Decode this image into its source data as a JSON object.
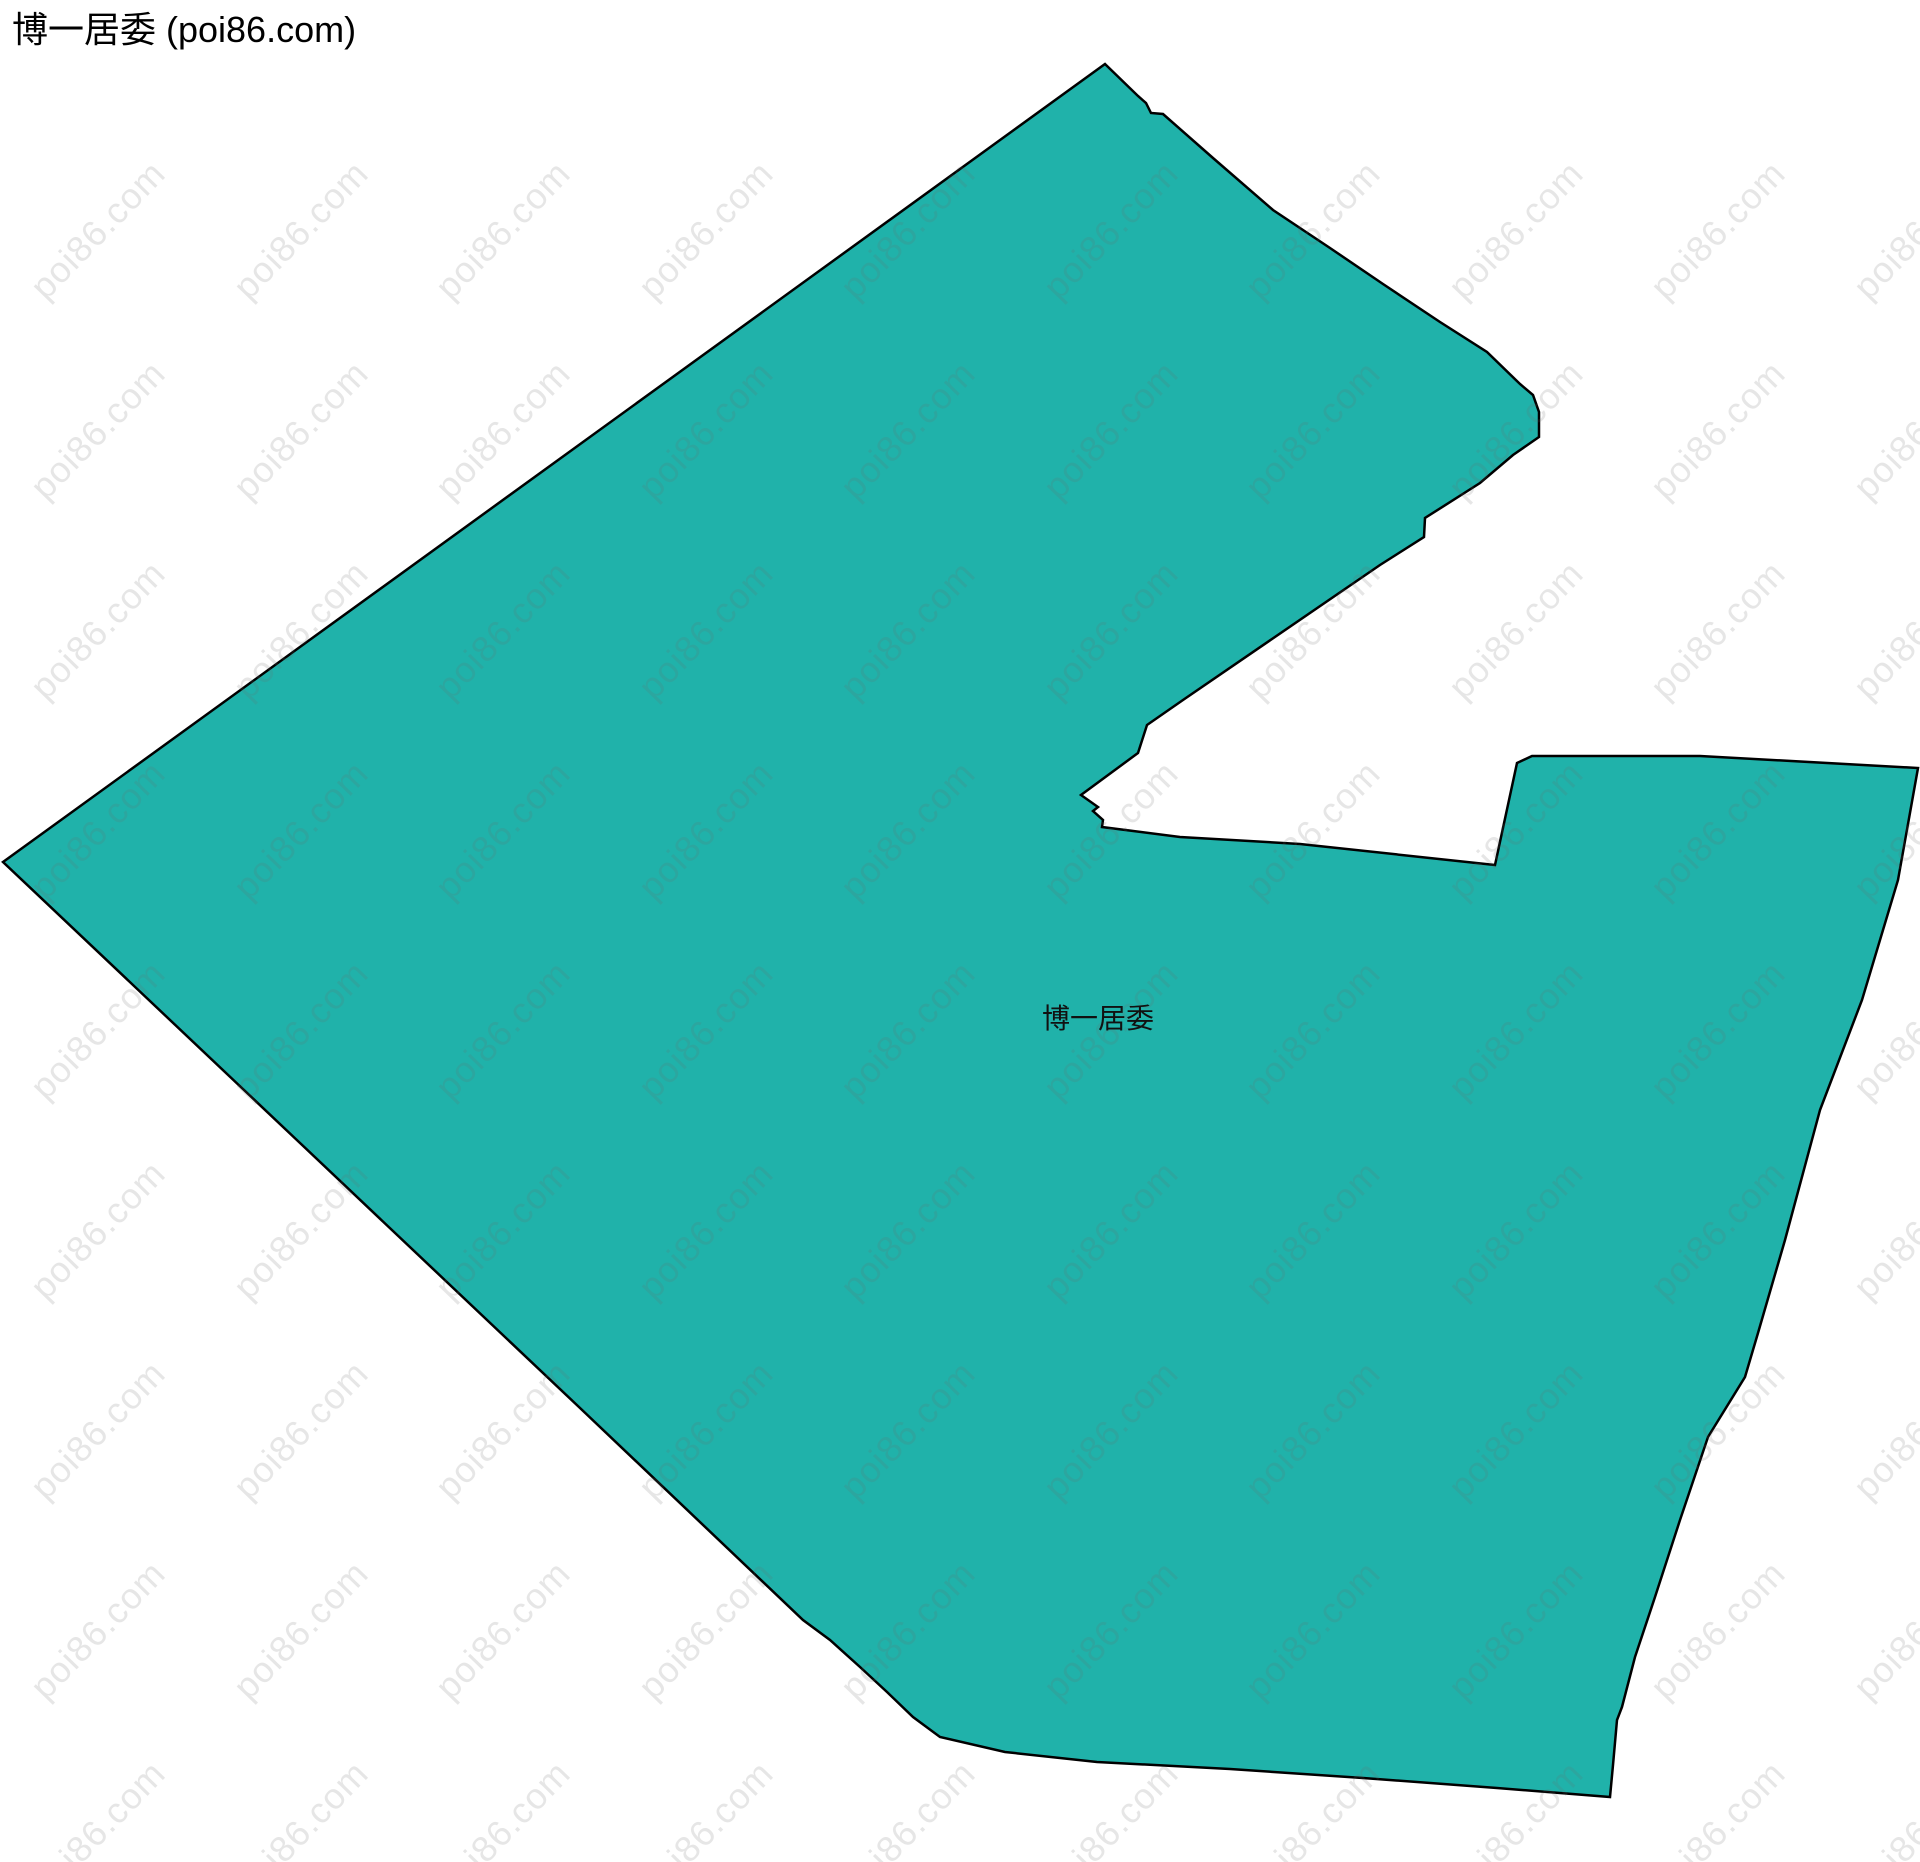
{
  "page": {
    "title": "博一居委 (poi86.com)"
  },
  "map": {
    "region_label": "博一居委",
    "watermark_text": "poi86.com",
    "colors": {
      "region_fill": "#20b2aa",
      "region_stroke": "#000000",
      "watermark": "#6a6a6a",
      "title_text": "#000000",
      "label_text": "#111111",
      "background": "#ffffff"
    },
    "boundary_points": [
      [
        1105,
        64
      ],
      [
        1138,
        96
      ],
      [
        1146,
        103
      ],
      [
        1151,
        113
      ],
      [
        1163,
        114
      ],
      [
        1213,
        158
      ],
      [
        1273,
        210
      ],
      [
        1330,
        248
      ],
      [
        1383,
        284
      ],
      [
        1440,
        322
      ],
      [
        1487,
        352
      ],
      [
        1520,
        384
      ],
      [
        1533,
        395
      ],
      [
        1539,
        412
      ],
      [
        1539,
        437
      ],
      [
        1513,
        455
      ],
      [
        1480,
        483
      ],
      [
        1425,
        518
      ],
      [
        1424,
        537
      ],
      [
        1380,
        565
      ],
      [
        1183,
        700
      ],
      [
        1147,
        725
      ],
      [
        1138,
        753
      ],
      [
        1081,
        795
      ],
      [
        1098,
        807
      ],
      [
        1093,
        811
      ],
      [
        1103,
        820
      ],
      [
        1102,
        827
      ],
      [
        1180,
        837
      ],
      [
        1300,
        844
      ],
      [
        1495,
        865
      ],
      [
        1517,
        763
      ],
      [
        1532,
        756
      ],
      [
        1700,
        756
      ],
      [
        1918,
        768
      ],
      [
        1898,
        880
      ],
      [
        1862,
        1000
      ],
      [
        1820,
        1110
      ],
      [
        1785,
        1240
      ],
      [
        1758,
        1333
      ],
      [
        1745,
        1377
      ],
      [
        1708,
        1437
      ],
      [
        1680,
        1520
      ],
      [
        1655,
        1597
      ],
      [
        1635,
        1657
      ],
      [
        1622,
        1707
      ],
      [
        1617,
        1720
      ],
      [
        1613,
        1765
      ],
      [
        1610,
        1797
      ],
      [
        1497,
        1788
      ],
      [
        1363,
        1778
      ],
      [
        1230,
        1769
      ],
      [
        1097,
        1762
      ],
      [
        1005,
        1752
      ],
      [
        940,
        1737
      ],
      [
        913,
        1717
      ],
      [
        887,
        1692
      ],
      [
        860,
        1667
      ],
      [
        830,
        1640
      ],
      [
        803,
        1620
      ],
      [
        580,
        1408
      ],
      [
        300,
        1143
      ],
      [
        3,
        862
      ]
    ]
  }
}
